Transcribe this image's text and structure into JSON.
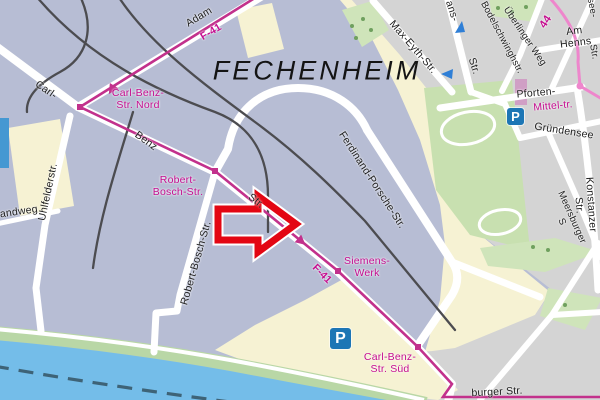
{
  "map": {
    "title": "FECHENHEIM",
    "labels": {
      "adam": "Adam",
      "f41_top": "F-41",
      "f41_bottom": "F-41",
      "carl": "Carl-",
      "benz": "Benz",
      "str_benz": "Str.",
      "carl_benz_nord": "Carl-Benz-\nStr. Nord",
      "robert_bosch_poi": "Robert-\nBosch-Str.",
      "robert_bosch": "Robert-Bosch-Str.",
      "uhlfelderstr": "Uhlfelderstr.",
      "randweg": "randweg",
      "ferdinand_porsche": "Ferdinand-Porsche-Str.",
      "siemens_werk": "Siemens-\nWerk",
      "carl_benz_sued": "Carl-Benz-\nStr. Süd",
      "max_eyth": "Max-Eyth-Str.",
      "ans": "ans-",
      "ans_str": "Str.",
      "bodelschwingh": "Bodelschwinghstr.",
      "ueberlinger": "Überlinger Weg",
      "am_henns": "Am Henns",
      "see": "see-",
      "see_str": "Str.",
      "route44": "44",
      "pforten": "Pforten-",
      "mittel": "Mittel-tr.",
      "gruendensee": "Gründensee",
      "konstanzer": "Konstanzer Str.",
      "meersburger": "Meersburger S",
      "burger": "burger Str.",
      "parking": "P"
    },
    "colors": {
      "magenta_label": "#c50d8f",
      "route_f41": "#c2318c",
      "route_44": "#ee86cc",
      "water": "#74bde9",
      "red_arrow": "#e30613",
      "parking_blue": "#1d76b5"
    }
  }
}
